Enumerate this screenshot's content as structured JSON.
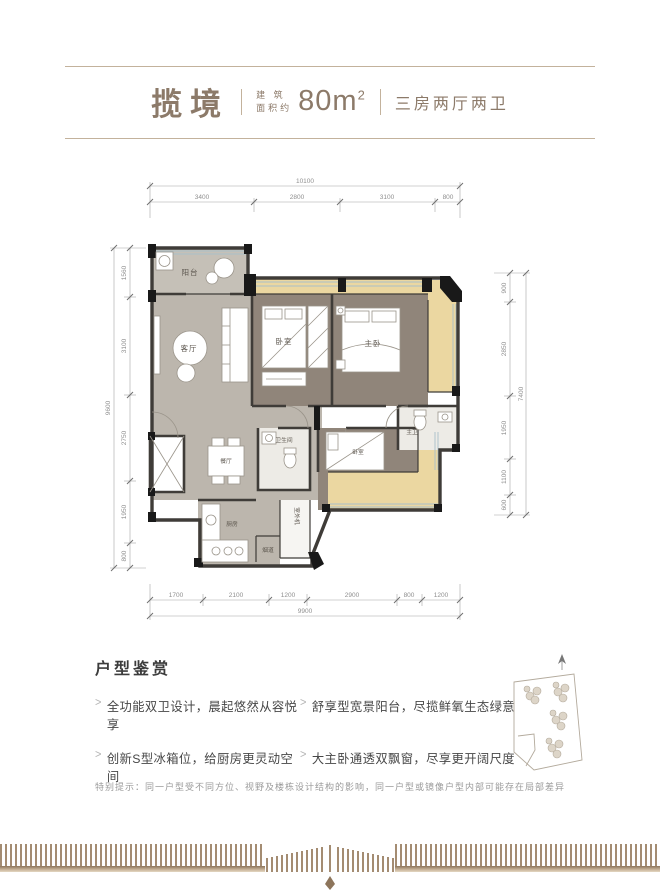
{
  "header": {
    "brand": "揽境",
    "area_label_top": "建 筑",
    "area_label_bottom": "面积约",
    "area_value": "80m",
    "area_sup": "2",
    "layout_type": "三房两厅两卫"
  },
  "plan": {
    "rooms": {
      "balcony": "阳台",
      "living": "客厅",
      "bedroom2": "卧室",
      "master": "主卧",
      "master_bath": "主卫",
      "dining": "餐厅",
      "bath": "卫生间",
      "bedroom3": "卧室",
      "kitchen": "厨房",
      "ac_unit": "室外机",
      "flue": "烟道"
    },
    "dims": {
      "top": {
        "total": "10100",
        "segments": [
          "3400",
          "2800",
          "3100",
          "800"
        ]
      },
      "bottom": {
        "total": "9900",
        "segments": [
          "1700",
          "2100",
          "1200",
          "2900",
          "800",
          "1200"
        ]
      },
      "left": {
        "total": "9600",
        "segments": [
          "1560",
          "3100",
          "2750",
          "1950",
          "800"
        ]
      },
      "right": {
        "total": "7400",
        "segments": [
          "900",
          "2850",
          "1950",
          "1100",
          "600"
        ]
      }
    }
  },
  "features": {
    "title": "户型鉴赏",
    "items": [
      "全功能双卫设计，晨起悠然从容悦享",
      "创新S型冰箱位，给厨房更灵动空间",
      "舒享型宽景阳台，尽揽鲜氧生态绿意",
      "大主卧通透双飘窗，尽享更开阔尺度"
    ]
  },
  "disclaimer": "特别提示：同一户型受不同方位、视野及楼栋设计结构的影响，同一户型或镜像户型内部可能存在局部差异",
  "colors": {
    "accent": "#8c7a69",
    "rule_line": "#c3b29c",
    "wall": "#3f3c38",
    "floor_gray": "#bcb6ad",
    "floor_brown": "#90857a",
    "floor_tan": "#ebd7a1",
    "deco_stripe": "#a48c72"
  }
}
